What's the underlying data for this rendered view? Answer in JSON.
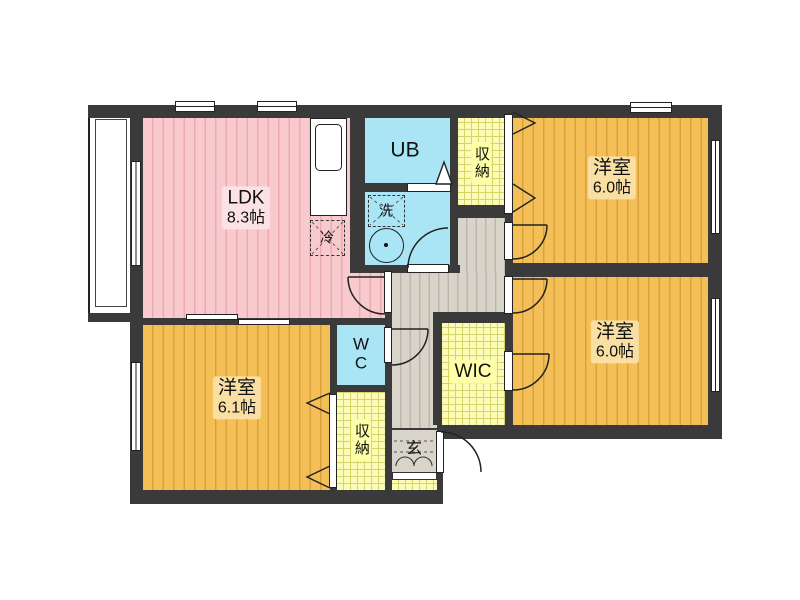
{
  "plan": {
    "type": "apartment-floor-plan",
    "rooms": {
      "ldk": {
        "name": "LDK",
        "size": "8.3帖"
      },
      "bedroom_ne": {
        "name": "洋室",
        "size": "6.0帖"
      },
      "bedroom_e": {
        "name": "洋室",
        "size": "6.0帖"
      },
      "bedroom_sw": {
        "name": "洋室",
        "size": "6.1帖"
      },
      "unit_bath": {
        "name": "UB"
      },
      "toilet": {
        "line1": "W",
        "line2": "C"
      },
      "wic": {
        "name": "WIC"
      },
      "closet_north": {
        "name": "収納"
      },
      "closet_south": {
        "name": "収納"
      },
      "entrance": {
        "name": "玄"
      },
      "washer": {
        "name": "洗"
      },
      "fridge": {
        "name": "冷"
      }
    },
    "colors": {
      "ldk_floor": "#f8cace",
      "bedroom_floor": "#f5bf58",
      "wet_area": "#aae5f6",
      "storage": "#fbfbb6",
      "hallway": "#d8d4c9",
      "wall": "#3a3a3a",
      "background": "#ffffff"
    }
  }
}
